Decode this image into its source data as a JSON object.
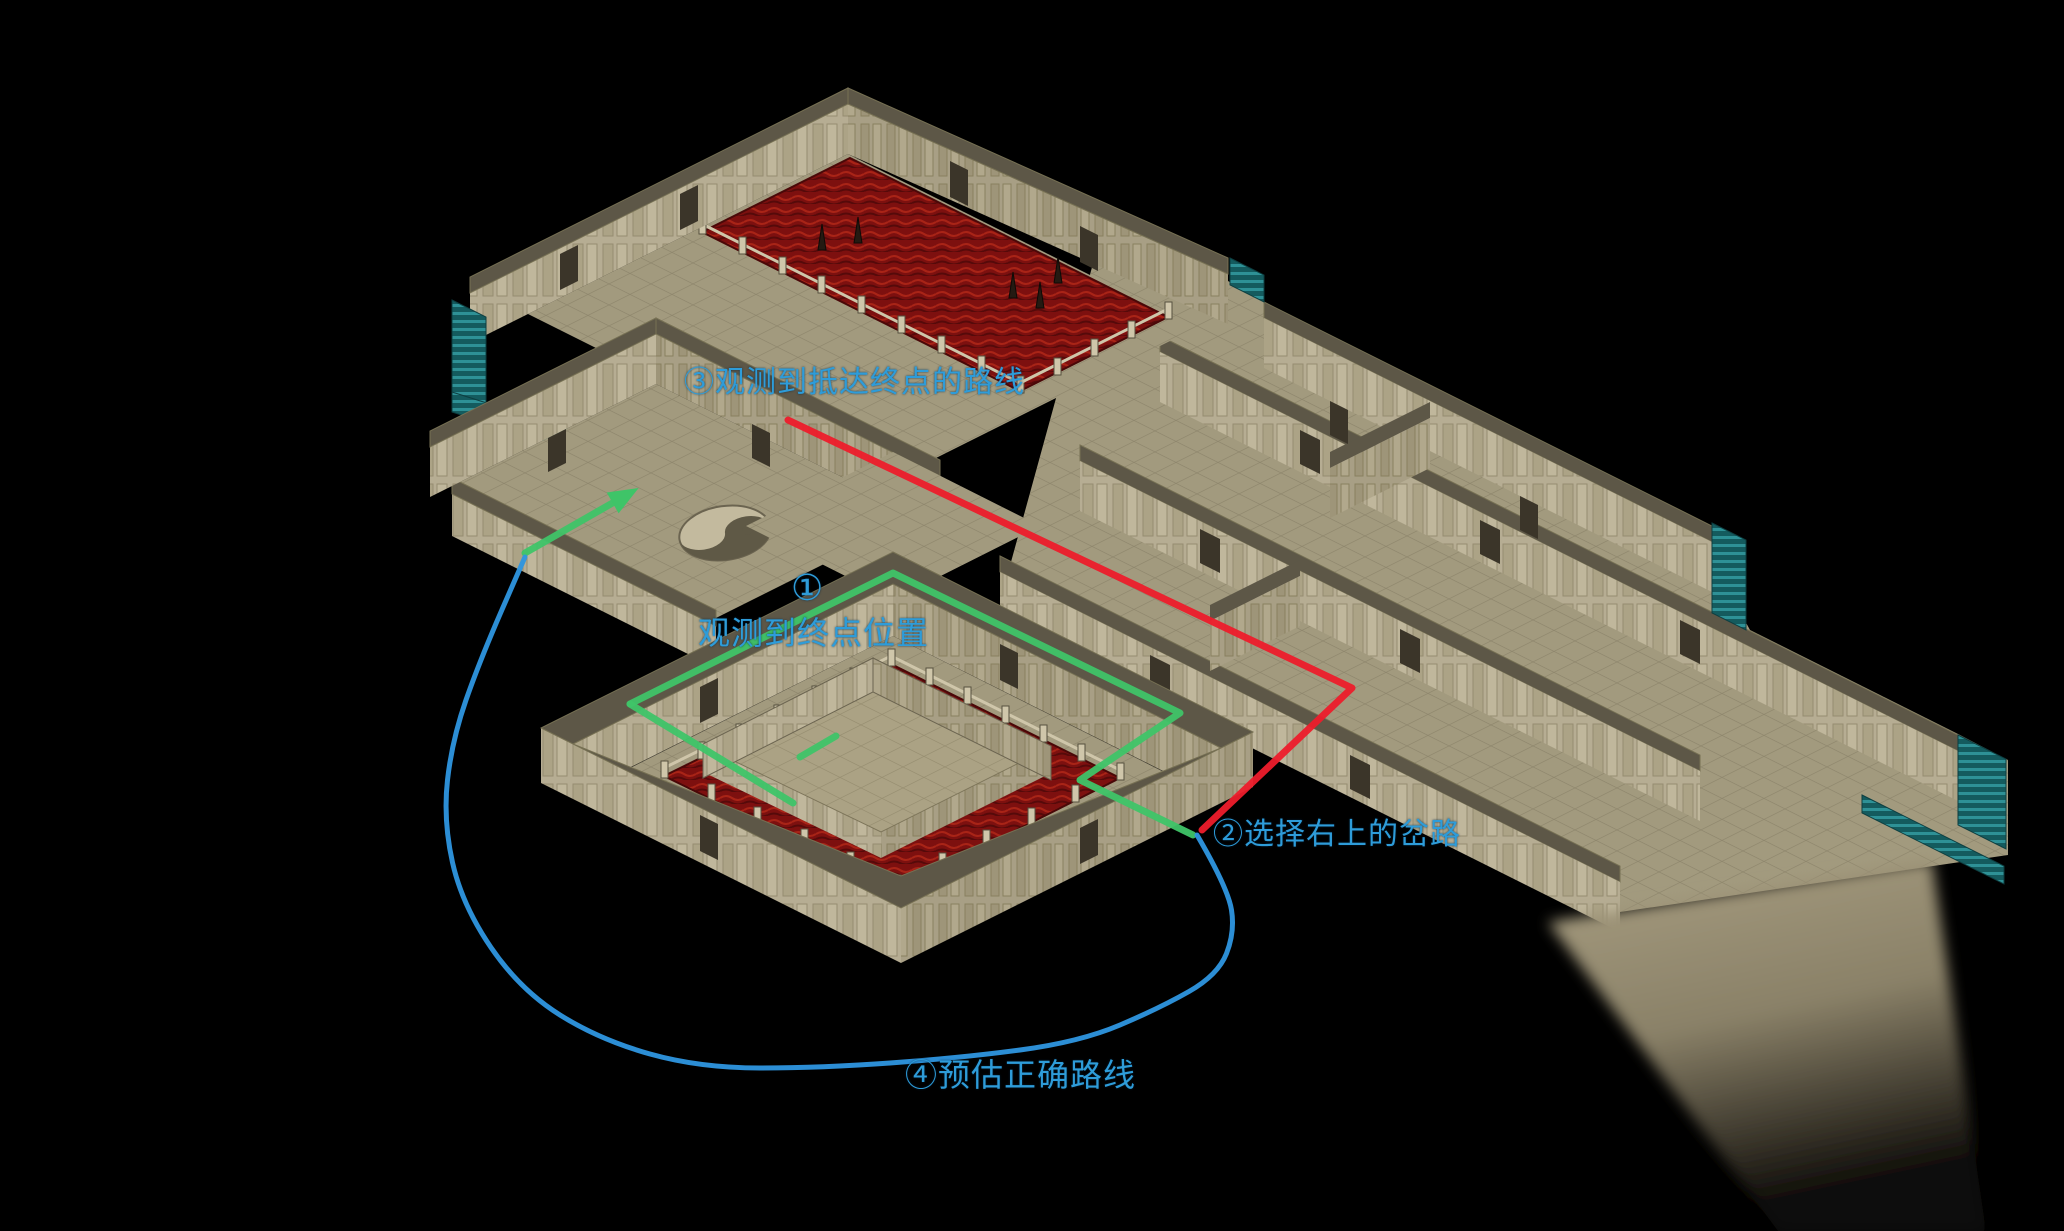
{
  "canvas": {
    "width": 2064,
    "height": 1231,
    "background": "#000000"
  },
  "scene": {
    "description": "isometric stone dungeon map with lava pools, a walled central courtyard platform, teal staircases and a yin-yang floor emblem",
    "style": "diablo-like-cathedral"
  },
  "annotations": {
    "text_color": "#2e9cd9",
    "labels": [
      {
        "id": "step3",
        "text": "③观测到抵达终点的路线",
        "x": 684,
        "y": 366,
        "size": 30
      },
      {
        "id": "step1-number",
        "text": "①",
        "x": 791,
        "y": 568,
        "size": 36
      },
      {
        "id": "step1",
        "text": "观测到终点位置",
        "x": 698,
        "y": 616,
        "size": 32
      },
      {
        "id": "step2",
        "text": "②选择右上的岔路",
        "x": 1213,
        "y": 818,
        "size": 30
      },
      {
        "id": "step4",
        "text": "④预估正确路线",
        "x": 905,
        "y": 1058,
        "size": 32
      }
    ],
    "paths": [
      {
        "name": "route-observed-red",
        "color": "#ed1c2b",
        "width": 7,
        "points": [
          [
            788,
            420
          ],
          [
            1352,
            688
          ],
          [
            1202,
            830
          ]
        ]
      },
      {
        "name": "route-loop-green-right",
        "color": "#3fc468",
        "width": 7,
        "points": [
          [
            630,
            704
          ],
          [
            893,
            573
          ],
          [
            1180,
            713
          ],
          [
            1080,
            780
          ],
          [
            1193,
            835
          ]
        ]
      },
      {
        "name": "route-loop-green-left",
        "color": "#3fc468",
        "width": 7,
        "points": [
          [
            630,
            704
          ],
          [
            793,
            803
          ]
        ]
      },
      {
        "name": "route-endpoint-stub-green",
        "color": "#3fc468",
        "width": 7,
        "points": [
          [
            800,
            757
          ],
          [
            836,
            736
          ]
        ]
      },
      {
        "name": "route-arrow-green",
        "color": "#3fc468",
        "width": 7,
        "arrow": true,
        "points": [
          [
            525,
            553
          ],
          [
            630,
            493
          ]
        ]
      },
      {
        "name": "route-estimated-blue",
        "color": "#2e96e0",
        "width": 5,
        "curve": true,
        "points": [
          [
            1197,
            835
          ],
          [
            1228,
            888
          ],
          [
            1235,
            932
          ],
          [
            1218,
            975
          ],
          [
            1160,
            1008
          ],
          [
            1080,
            1042
          ],
          [
            960,
            1058
          ],
          [
            820,
            1068
          ],
          [
            700,
            1068
          ],
          [
            600,
            1040
          ],
          [
            520,
            990
          ],
          [
            462,
            905
          ],
          [
            443,
            820
          ],
          [
            452,
            740
          ],
          [
            480,
            660
          ],
          [
            525,
            557
          ]
        ]
      }
    ]
  },
  "map_palette": {
    "background": "#000000",
    "floor": "#a29a7e",
    "floor_grid": "#8e866c",
    "wall_face": "#b6ad93",
    "wall_face_shade": "#a89f85",
    "roof_ledge": "#5d5747",
    "lava_base": "#7d100f",
    "lava_glow": "#a92417",
    "stairs_teal": "#2e9196",
    "stairs_teal_dark": "#145b5e",
    "emblem_light": "#c3ba9e",
    "emblem_dark": "#5f5946"
  },
  "icons": {
    "yin_yang": "yin-yang floor emblem",
    "spike": "dark stalagmite spike in lava",
    "stairs": "teal staircase"
  }
}
